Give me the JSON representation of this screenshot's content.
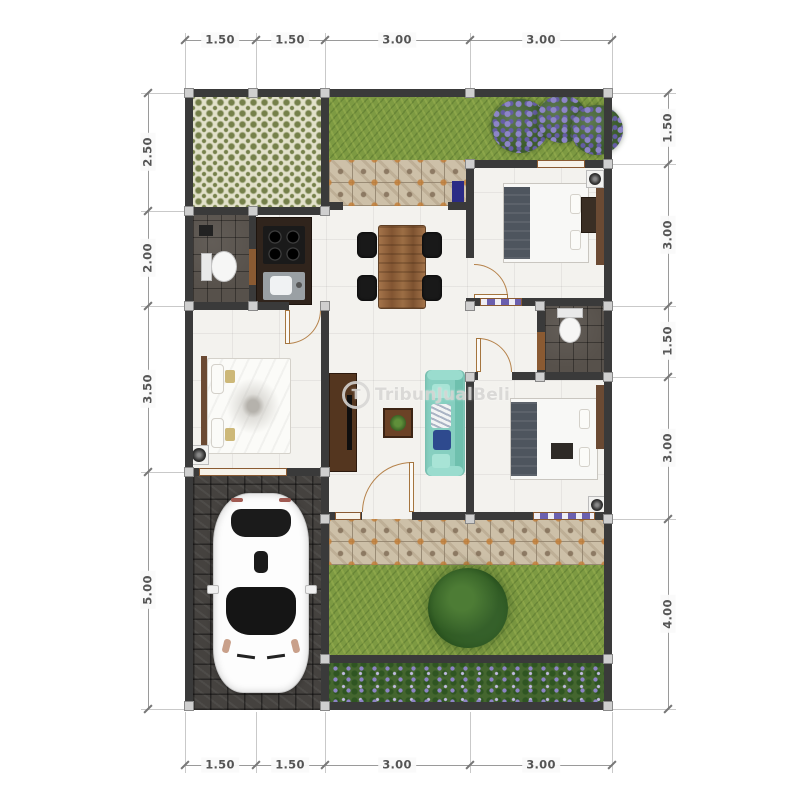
{
  "watermark": {
    "logo_letter": "T",
    "text": "TribunJualBeli"
  },
  "dimensions": {
    "top": [
      "1.50",
      "1.50",
      "3.00",
      "3.00"
    ],
    "bottom": [
      "1.50",
      "1.50",
      "3.00",
      "3.00"
    ],
    "left": [
      "2.50",
      "2.00",
      "3.50",
      "5.00"
    ],
    "right": [
      "1.50",
      "3.00",
      "1.50",
      "3.00",
      "4.00"
    ]
  },
  "colors": {
    "wall": "#3a3a3a",
    "floor": "#f3f2ee",
    "grass": "#7d9a42",
    "tile_accent": "#cdc0a8",
    "carport": "#45423f",
    "pattern_green": "#75804a",
    "flower_purple": "#6b5fae",
    "sofa": "#86cfc0",
    "wood": "#8a5a32",
    "dim_text": "#555555"
  }
}
